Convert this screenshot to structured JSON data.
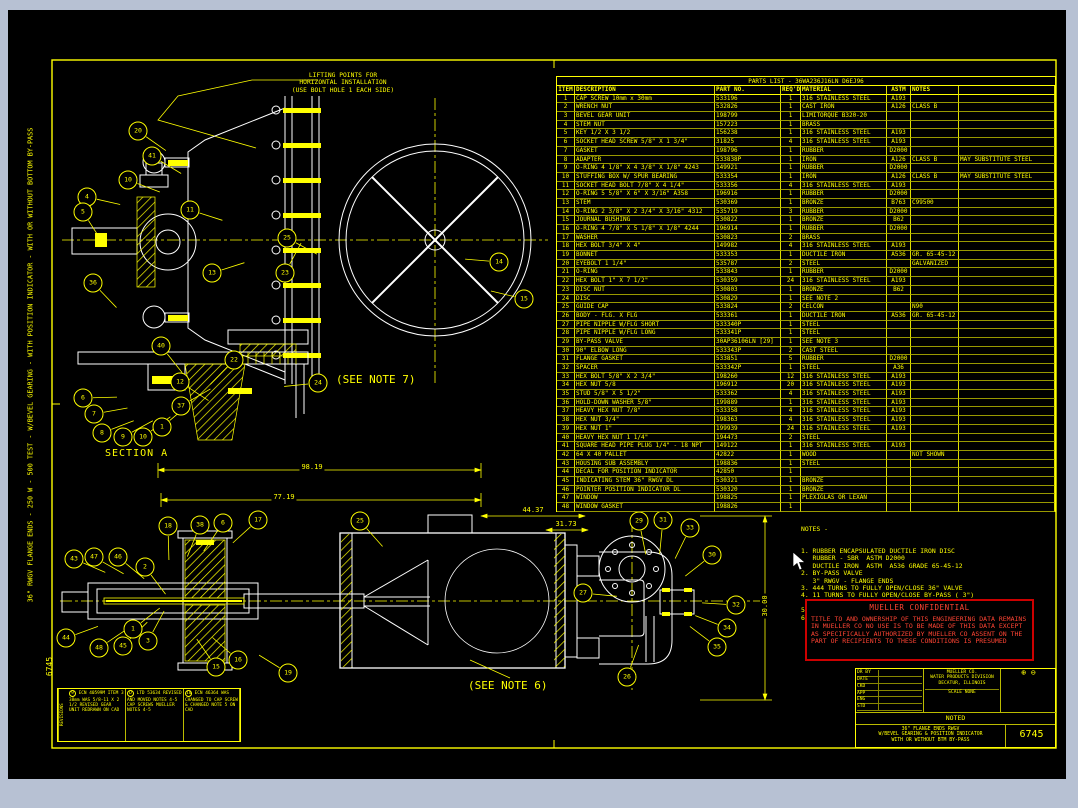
{
  "colors": {
    "line_yellow": "#ffff00",
    "line_white": "#ffffff",
    "alert_red": "#ff3333",
    "canvas_black": "#000000",
    "page_gray": "#b7c1d3"
  },
  "edge": {
    "left_vertical_text": "36\" RWGV FLANGE ENDS - 250 W - 500 TEST - W/BEVEL GEARING - WITH POSITION INDICATOR - WITH OR WITHOUT BOTTOM BY-PASS",
    "corner_number": "6745"
  },
  "annotations": {
    "lifting_note": "LIFTING POINTS FOR\nHORIZONTAL INSTALLATION\n(USE BOLT HOLE 1 EACH SIDE)",
    "section_label": "SECTION A",
    "see_note_7": "(SEE NOTE 7)",
    "see_note_6": "(SEE NOTE 6)"
  },
  "dimensions": {
    "d1": "98.19",
    "d2": "77.19",
    "d3": "44.37",
    "d4": "31.73",
    "d5": "30.00"
  },
  "callouts": [
    {
      "n": "20",
      "x": 138,
      "y": 131
    },
    {
      "n": "41",
      "x": 152,
      "y": 156
    },
    {
      "n": "4",
      "x": 87,
      "y": 197
    },
    {
      "n": "10",
      "x": 128,
      "y": 180
    },
    {
      "n": "5",
      "x": 83,
      "y": 212
    },
    {
      "n": "11",
      "x": 190,
      "y": 210
    },
    {
      "n": "36",
      "x": 93,
      "y": 283
    },
    {
      "n": "13",
      "x": 212,
      "y": 273
    },
    {
      "n": "23",
      "x": 285,
      "y": 273
    },
    {
      "n": "40",
      "x": 161,
      "y": 346
    },
    {
      "n": "22",
      "x": 234,
      "y": 360
    },
    {
      "n": "25",
      "x": 287,
      "y": 238
    },
    {
      "n": "24",
      "x": 318,
      "y": 383
    },
    {
      "n": "14",
      "x": 499,
      "y": 262
    },
    {
      "n": "15",
      "x": 524,
      "y": 299
    },
    {
      "n": "12",
      "x": 180,
      "y": 382
    },
    {
      "n": "37",
      "x": 181,
      "y": 406
    },
    {
      "n": "6",
      "x": 83,
      "y": 398
    },
    {
      "n": "7",
      "x": 94,
      "y": 414
    },
    {
      "n": "8",
      "x": 102,
      "y": 433
    },
    {
      "n": "9",
      "x": 123,
      "y": 437
    },
    {
      "n": "10",
      "x": 143,
      "y": 437
    },
    {
      "n": "1",
      "x": 162,
      "y": 427
    },
    {
      "n": "18",
      "x": 168,
      "y": 526
    },
    {
      "n": "38",
      "x": 200,
      "y": 525
    },
    {
      "n": "6",
      "x": 223,
      "y": 523
    },
    {
      "n": "17",
      "x": 258,
      "y": 520
    },
    {
      "n": "25",
      "x": 360,
      "y": 521
    },
    {
      "n": "43",
      "x": 74,
      "y": 559
    },
    {
      "n": "47",
      "x": 94,
      "y": 557
    },
    {
      "n": "46",
      "x": 118,
      "y": 557
    },
    {
      "n": "2",
      "x": 145,
      "y": 567
    },
    {
      "n": "44",
      "x": 66,
      "y": 638
    },
    {
      "n": "48",
      "x": 99,
      "y": 648
    },
    {
      "n": "45",
      "x": 123,
      "y": 646
    },
    {
      "n": "1",
      "x": 133,
      "y": 629
    },
    {
      "n": "3",
      "x": 148,
      "y": 641
    },
    {
      "n": "15",
      "x": 216,
      "y": 667
    },
    {
      "n": "16",
      "x": 238,
      "y": 660
    },
    {
      "n": "19",
      "x": 288,
      "y": 673
    },
    {
      "n": "29",
      "x": 639,
      "y": 521
    },
    {
      "n": "31",
      "x": 663,
      "y": 520
    },
    {
      "n": "33",
      "x": 690,
      "y": 528
    },
    {
      "n": "30",
      "x": 712,
      "y": 555
    },
    {
      "n": "27",
      "x": 583,
      "y": 593
    },
    {
      "n": "32",
      "x": 736,
      "y": 605
    },
    {
      "n": "34",
      "x": 727,
      "y": 628
    },
    {
      "n": "35",
      "x": 717,
      "y": 647
    },
    {
      "n": "26",
      "x": 627,
      "y": 677
    }
  ],
  "parts_list": {
    "title": "PARTS LIST - 36WA236J16LN D6EJ96",
    "columns": [
      "ITEM",
      "DESCRIPTION",
      "PART NO.",
      "REQ'D",
      "MATERIAL",
      "ASTM",
      "NOTES",
      ""
    ],
    "rows": [
      [
        "1",
        "CAP SCREW 10mm x 30mm",
        "533196",
        "1",
        "316 STAINLESS STEEL",
        "A193",
        "",
        ""
      ],
      [
        "2",
        "WRENCH NUT",
        "532826",
        "1",
        "CAST IRON",
        "A126",
        "CLASS B",
        ""
      ],
      [
        "3",
        "BEVEL GEAR UNIT",
        "198799",
        "1",
        "LIMITORQUE B320-20",
        "",
        "",
        ""
      ],
      [
        "4",
        "STEM NUT",
        "157223",
        "1",
        "BRASS",
        "",
        "",
        ""
      ],
      [
        "5",
        "KEY 1/2 X 3 1/2",
        "156238",
        "1",
        "316 STAINLESS STEEL",
        "A193",
        "",
        ""
      ],
      [
        "6",
        "SOCKET HEAD SCREW 5/8\" X 1 3/4\"",
        "31825",
        "4",
        "316 STAINLESS STEEL",
        "A193",
        "",
        ""
      ],
      [
        "7",
        "GASKET",
        "198796",
        "1",
        "RUBBER",
        "D2000",
        "",
        ""
      ],
      [
        "8",
        "ADAPTER",
        "533838P",
        "1",
        "IRON",
        "A126",
        "CLASS B",
        "MAY SUBSTITUTE STEEL"
      ],
      [
        "9",
        "O-RING 4 1/8\" X 4 3/8\" X 1/8\" 4243",
        "149921",
        "1",
        "RUBBER",
        "D2000",
        "",
        ""
      ],
      [
        "10",
        "STUFFING BOX W/ SPUR BEARING",
        "533354",
        "1",
        "IRON",
        "A126",
        "CLASS B",
        "MAY SUBSTITUTE STEEL"
      ],
      [
        "11",
        "SOCKET HEAD BOLT 7/8\" X 4 1/4\"",
        "533356",
        "4",
        "316 STAINLESS STEEL",
        "A193",
        "",
        ""
      ],
      [
        "12",
        "O-RING 5 5/8\" X 6\" X 3/16\" A358",
        "196916",
        "1",
        "RUBBER",
        "D2000",
        "",
        ""
      ],
      [
        "13",
        "STEM",
        "530369",
        "1",
        "BRONZE",
        "B763",
        "C99500",
        ""
      ],
      [
        "14",
        "O-RING 2 3/8\" X 2 3/4\" X 3/16\" 4312",
        "535719",
        "3",
        "RUBBER",
        "D2000",
        "",
        ""
      ],
      [
        "15",
        "JOURNAL BUSHING",
        "530822",
        "1",
        "BRONZE",
        "B62",
        "",
        ""
      ],
      [
        "16",
        "O-RING 4 7/8\" X 5 1/8\" X 1/8\" 4244",
        "196914",
        "1",
        "RUBBER",
        "D2000",
        "",
        ""
      ],
      [
        "17",
        "WASHER",
        "530823",
        "2",
        "BRASS",
        "",
        "",
        ""
      ],
      [
        "18",
        "HEX BOLT 3/4\" X 4\"",
        "149982",
        "4",
        "316 STAINLESS STEEL",
        "A193",
        "",
        ""
      ],
      [
        "19",
        "BONNET",
        "533353",
        "1",
        "DUCTILE IRON",
        "A536",
        "GR. 65-45-12",
        ""
      ],
      [
        "20",
        "EYEBOLT 1 1/4\"",
        "535787",
        "2",
        "STEEL",
        "",
        "GALVANIZED",
        ""
      ],
      [
        "21",
        "O-RING",
        "533843",
        "1",
        "RUBBER",
        "D2000",
        "",
        ""
      ],
      [
        "22",
        "HEX BOLT 1\" X 7 1/2\"",
        "530359",
        "24",
        "316 STAINLESS STEEL",
        "A193",
        "",
        ""
      ],
      [
        "23",
        "DISC NUT",
        "530803",
        "1",
        "BRONZE",
        "B62",
        "",
        ""
      ],
      [
        "24",
        "DISC",
        "530829",
        "1",
        "SEE NOTE 2",
        "",
        "",
        ""
      ],
      [
        "25",
        "GUIDE CAP",
        "533824",
        "2",
        "CELCON",
        "",
        "N90",
        ""
      ],
      [
        "26",
        "BODY - FLG. X FLG",
        "533361",
        "1",
        "DUCTILE IRON",
        "A536",
        "GR. 65-45-12",
        ""
      ],
      [
        "27",
        "PIPE NIPPLE W/FLG SHORT",
        "533340P",
        "1",
        "STEEL",
        "",
        "",
        ""
      ],
      [
        "28",
        "PIPE NIPPLE W/FLG LONG",
        "533341P",
        "1",
        "STEEL",
        "",
        "",
        ""
      ],
      [
        "29",
        "BY-PASS VALVE",
        "30AP36106LN [29]",
        "1",
        "SEE NOTE 3",
        "",
        "",
        ""
      ],
      [
        "30",
        "90° ELBOW LONG",
        "533343P",
        "2",
        "CAST STEEL",
        "",
        "",
        ""
      ],
      [
        "31",
        "FLANGE GASKET",
        "533851",
        "5",
        "RUBBER",
        "D2000",
        "",
        ""
      ],
      [
        "32",
        "SPACER",
        "533342P",
        "1",
        "STEEL",
        "A36",
        "",
        ""
      ],
      [
        "33",
        "HEX BOLT 5/8\" X 2 3/4\"",
        "198260",
        "12",
        "316 STAINLESS STEEL",
        "A193",
        "",
        ""
      ],
      [
        "34",
        "HEX NUT 5/8",
        "196912",
        "20",
        "316 STAINLESS STEEL",
        "A193",
        "",
        ""
      ],
      [
        "35",
        "STUD 5/8\" X 5 1/2\"",
        "533362",
        "4",
        "316 STAINLESS STEEL",
        "A193",
        "",
        ""
      ],
      [
        "36",
        "HOLD-DOWN WASHER 5/8\"",
        "199889",
        "1",
        "316 STAINLESS STEEL",
        "A193",
        "",
        ""
      ],
      [
        "37",
        "HEAVY HEX NUT 7/8\"",
        "533358",
        "4",
        "316 STAINLESS STEEL",
        "A193",
        "",
        ""
      ],
      [
        "38",
        "HEX NUT 3/4\"",
        "198363",
        "4",
        "316 STAINLESS STEEL",
        "A193",
        "",
        ""
      ],
      [
        "39",
        "HEX NUT 1\"",
        "199939",
        "24",
        "316 STAINLESS STEEL",
        "A193",
        "",
        ""
      ],
      [
        "40",
        "HEAVY HEX NUT 1 1/4\"",
        "194473",
        "2",
        "STEEL",
        "",
        "",
        ""
      ],
      [
        "41",
        "SQUARE HEAD PIPE PLUG 1/4\" - 18 NPT",
        "149122",
        "1",
        "316 STAINLESS STEEL",
        "A193",
        "",
        ""
      ],
      [
        "42",
        "64 X 40 PALLET",
        "42822",
        "1",
        "WOOD",
        "",
        "NOT SHOWN",
        ""
      ],
      [
        "43",
        "HOUSING SUB ASSEMBLY",
        "198836",
        "1",
        "STEEL",
        "",
        "",
        ""
      ],
      [
        "44",
        "DECAL FOR POSITION INDICATOR",
        "42850",
        "1",
        "",
        "",
        "",
        ""
      ],
      [
        "45",
        "INDICATING STEM 36\" RWGV DL",
        "530321",
        "1",
        "BRONZE",
        "",
        "",
        ""
      ],
      [
        "46",
        "POINTER POSITION INDICATOR DL",
        "530320",
        "1",
        "BRONZE",
        "",
        "",
        ""
      ],
      [
        "47",
        "WINDOW",
        "198825",
        "1",
        "PLEXIGLAS OR LEXAN",
        "",
        "",
        ""
      ],
      [
        "48",
        "WINDOW GASKET",
        "198826",
        "1",
        "",
        "",
        "",
        ""
      ]
    ]
  },
  "notes": {
    "header": "NOTES -",
    "lines": [
      "1. RUBBER ENCAPSULATED DUCTILE IRON DISC",
      "   RUBBER - SBR  ASTM D2000",
      "   DUCTILE IRON  ASTM  A536 GRADE 65-45-12",
      "2. BY-PASS VALVE",
      "   3\" RWGV - FLANGE ENDS",
      "3. 444 TURNS TO FULLY OPEN/CLOSE 36\" VALVE",
      "4. 11 TURNS TO FULLY OPEN/CLOSE BY-PASS ( 3\")",
      "   VALVE",
      "5. 36\" VALVE WITH BY-PASS",
      "6. 36\" VALVE WITHOUT BY-PASS"
    ]
  },
  "confidential": {
    "title": "MUELLER CONFIDENTIAL",
    "body": "TITLE TO AND OWNERSHIP OF THIS ENGINEERING DATA REMAINS IN MUELLER CO  NO USE IS TO BE MADE OF THIS DATA EXCEPT AS SPECIFICALLY AUTHORIZED BY MUELLER CO  ASSENT ON THE PART OF RECIPIENTS TO THESE CONDITIONS IS PRESUMED"
  },
  "title_block": {
    "company_line1": "MUELLER CO.",
    "company_line2": "WATER PRODUCTS DIVISION",
    "company_line3": "DECATUR, ILLINOIS",
    "scale": "SCALE NONE",
    "tolerance": "NOTED",
    "title_line1": "36\" FLANGE ENDS RWGV",
    "title_line2": "W/BEVEL GEARING & POSITION INDICATOR",
    "title_line3": "WITH OR WITHOUT BTM BY-PASS",
    "dwg_no": "6745",
    "left_labels": [
      "DR BY",
      "DATE",
      "CKD",
      "APP",
      "ENG",
      "STD"
    ],
    "projection_symbol": "⊕ ⊖"
  },
  "revisions": [
    {
      "mark": "9",
      "text": "ECN 40599M ITEM 3 38mm WAS 5/8-11 X 2 1/2 REVISED GEAR UNIT REDRAWN ON CAD"
    },
    {
      "mark": "D",
      "text": "LTD 53634 REVISED AND MOVED NOTES 4-5 CAP SCREWS MUELLER NOTES 4-5"
    },
    {
      "mark": "10",
      "text": "ECN 46364 WAS CHANGED TO CAP SCREW & CHANGED NOTE 5 ON CAD"
    }
  ],
  "revisions_label": "REVISIONS"
}
